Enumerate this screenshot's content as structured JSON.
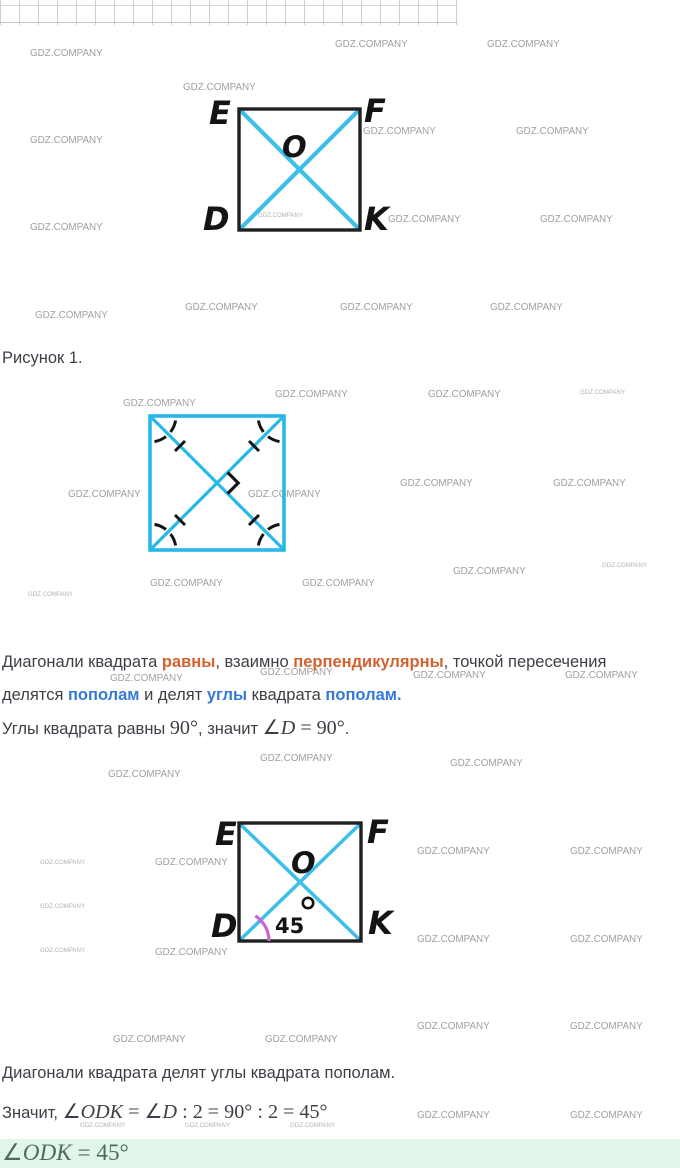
{
  "watermark": {
    "text": "GDZ.COMPANY",
    "color": "#8f8f8f"
  },
  "watermarks": [
    [
      335,
      38
    ],
    [
      487,
      38
    ],
    [
      30,
      47
    ],
    [
      183,
      81
    ],
    [
      363,
      125
    ],
    [
      516,
      125
    ],
    [
      30,
      134
    ],
    [
      258,
      212,
      1
    ],
    [
      388,
      213
    ],
    [
      540,
      213
    ],
    [
      30,
      221
    ],
    [
      185,
      301
    ],
    [
      340,
      301
    ],
    [
      490,
      301
    ],
    [
      35,
      309
    ],
    [
      275,
      388
    ],
    [
      428,
      388
    ],
    [
      580,
      389,
      1
    ],
    [
      123,
      397
    ],
    [
      400,
      477
    ],
    [
      553,
      477
    ],
    [
      68,
      488
    ],
    [
      248,
      488
    ],
    [
      453,
      565
    ],
    [
      602,
      562,
      1
    ],
    [
      150,
      577
    ],
    [
      302,
      577
    ],
    [
      28,
      591,
      1
    ],
    [
      260,
      666
    ],
    [
      110,
      672
    ],
    [
      413,
      669
    ],
    [
      565,
      669
    ],
    [
      260,
      752
    ],
    [
      450,
      757
    ],
    [
      108,
      768
    ],
    [
      417,
      845
    ],
    [
      570,
      845
    ],
    [
      155,
      856
    ],
    [
      40,
      859,
      1
    ],
    [
      40,
      903,
      1
    ],
    [
      417,
      933
    ],
    [
      570,
      933
    ],
    [
      155,
      946
    ],
    [
      40,
      947,
      1
    ],
    [
      417,
      1020
    ],
    [
      570,
      1020
    ],
    [
      113,
      1033
    ],
    [
      265,
      1033
    ],
    [
      417,
      1109
    ],
    [
      570,
      1109
    ],
    [
      80,
      1122,
      1
    ],
    [
      185,
      1122,
      1
    ],
    [
      290,
      1122,
      1
    ]
  ],
  "caption_fig1": "Рисунок 1.",
  "fig1": {
    "labels": {
      "tl": "E",
      "tr": "F",
      "bl": "D",
      "br": "K",
      "center": "O"
    }
  },
  "fig3": {
    "labels": {
      "tl": "E",
      "tr": "F",
      "bl": "D",
      "br": "K",
      "center": "O",
      "angle": "45",
      "degree_note": "degree shown as circle glyph"
    }
  },
  "paragraph1": [
    {
      "t": "Диагонали квадрата "
    },
    {
      "t": "равны",
      "c": "b o"
    },
    {
      "t": ", взаимно "
    },
    {
      "t": "перпендикулярны",
      "c": "b o"
    },
    {
      "t": ", точкой пересечения"
    },
    {
      "br": 1
    },
    {
      "t": "делятся "
    },
    {
      "t": "пополам",
      "c": "b bl"
    },
    {
      "t": " и делят "
    },
    {
      "t": "углы",
      "c": "b bl"
    },
    {
      "t": " квадрата "
    },
    {
      "t": "пополам.",
      "c": "b bl"
    }
  ],
  "line_angles": [
    {
      "t": "Углы квадрата равны "
    },
    {
      "t": "90°",
      "c": "m"
    },
    {
      "t": ", значит "
    },
    {
      "t": "∠",
      "c": "m"
    },
    {
      "t": "D",
      "c": "m i"
    },
    {
      "t": " = 90°",
      "c": "m"
    },
    {
      "t": "."
    }
  ],
  "line_bisect": "Диагонали квадрата делят углы квадрата пополам.",
  "line_therefore": [
    {
      "t": "Значит, "
    },
    {
      "t": "∠",
      "c": "m"
    },
    {
      "t": "ODK",
      "c": "m i"
    },
    {
      "t": " = ∠",
      "c": "m"
    },
    {
      "t": "D",
      "c": "m i"
    },
    {
      "t": " : 2 = 90° : 2 = 45°",
      "c": "m"
    }
  ],
  "answer": [
    {
      "t": "∠",
      "c": "m"
    },
    {
      "t": "ODK",
      "c": "m i"
    },
    {
      "t": " = 45°",
      "c": "m"
    }
  ],
  "colors": {
    "cyan_diagonal": "#3ebfe9",
    "cyan_square2": "#27b8e8",
    "black_outline": "#202020",
    "orange_keyword": "#d4622f",
    "blue_keyword": "#3579d8",
    "pink_arc": "#cb63d6",
    "answer_bg": "#e2f5ea",
    "answer_fg": "#4a6b5e",
    "watermark_gray": "#8f8f8f",
    "body_text": "#3e3e47"
  }
}
